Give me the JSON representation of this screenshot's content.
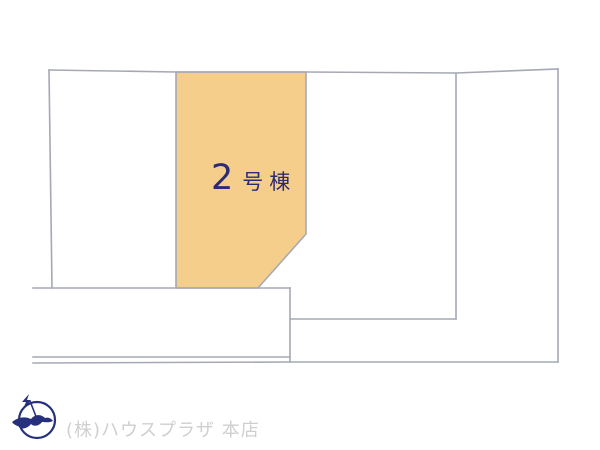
{
  "diagram": {
    "type": "real-estate-site-plan",
    "highlighted_plot": {
      "label": "2号棟",
      "label_number": "2",
      "label_suffix": "号棟",
      "fill_color": "#f6ce8c",
      "label_color": "#2b2c72"
    },
    "line_color": "#a6a9b4"
  },
  "footer": {
    "company": "(株)ハウスプラザ 本店",
    "text_color": "#cfcfd1",
    "logo_icon": "compass-bird-logo",
    "logo_color": "#27307c"
  }
}
